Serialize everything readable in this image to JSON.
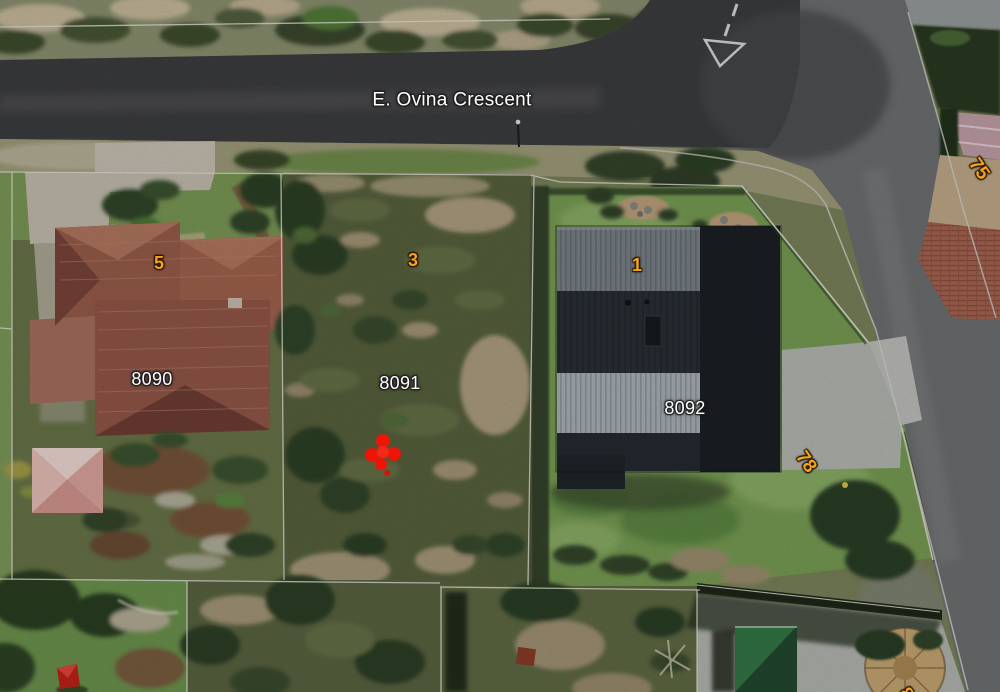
{
  "map": {
    "type": "aerial-satellite-cadastral-view",
    "street": {
      "name": "E. Ovina Crescent"
    },
    "erf_labels": [
      {
        "id": "erf-8090",
        "text": "8090"
      },
      {
        "id": "erf-8091",
        "text": "8091"
      },
      {
        "id": "erf-8092",
        "text": "8092"
      }
    ],
    "lot_labels": [
      {
        "id": "lot-5",
        "text": "5"
      },
      {
        "id": "lot-3",
        "text": "3"
      },
      {
        "id": "lot-1",
        "text": "1"
      },
      {
        "id": "lot-78",
        "text": "78"
      },
      {
        "id": "lot-75",
        "text": "75"
      },
      {
        "id": "lot-partial-8",
        "text": "8"
      }
    ],
    "marker": {
      "name": "red-location-marker",
      "color": "#ee1507"
    },
    "colors": {
      "lot_label": "#f6a21d",
      "erf_label": "#ffffff",
      "boundary_line": "#e6e6da",
      "asphalt_dark": "#3e3f41",
      "asphalt_light": "#707274",
      "roof_terracotta": "#9c5f4c",
      "roof_charcoal": "#2b3137"
    }
  }
}
